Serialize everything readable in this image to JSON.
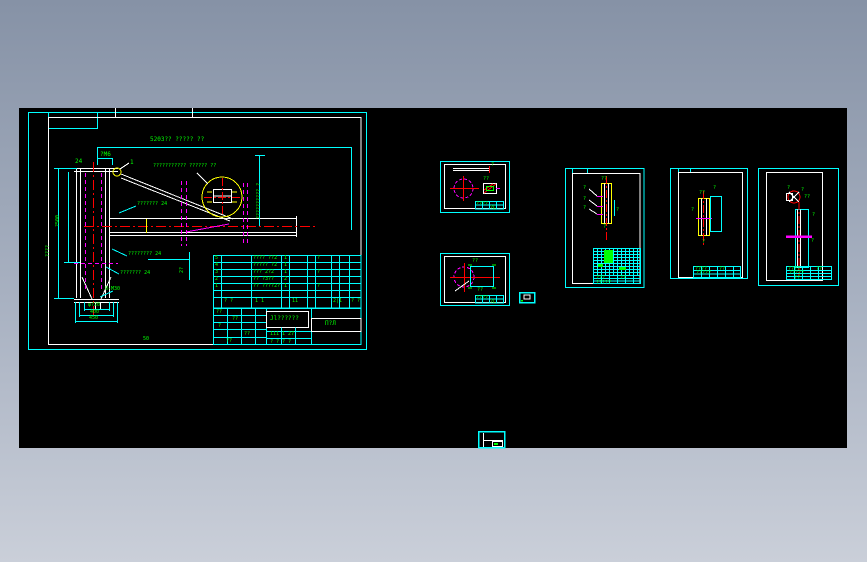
{
  "app": {
    "type": "cad-drawing-viewer",
    "canvas_color": "#000000",
    "background_top": "#8692a6",
    "background_bottom": "#cacfd9"
  },
  "palette": {
    "sheet_frame": "#00ffff",
    "inner_frame": "#ffffff",
    "annotation": "#00ff00",
    "centerline": "#ff0000",
    "hidden_line": "#ff00ff",
    "detail": "#ffff00"
  },
  "main_sheet": {
    "labels": {
      "dim_top": "5203?? ????? ??",
      "leader_detail": "??????????? ?????? ??",
      "detail_no": "1",
      "note_m6": "?M6",
      "note_24": "24",
      "leader_mid": "??????? 24",
      "leader_low": "???????? 24",
      "leader_lower": "??????? 24",
      "anchor": "8-M30",
      "base_d1": "φ?20",
      "base_d2": "400",
      "base_d3": "450",
      "dim_left_outer": "????",
      "dim_left_inner": "?500",
      "dim_right_vert": "?????????? ?",
      "dim_gap": "2?",
      "sheet_no": "50"
    },
    "bom": {
      "rows": [
        {
          "no": "5",
          "name": "???? ??2",
          "qty": "1",
          "mat": "?"
        },
        {
          "no": "4",
          "name": "????? ?2",
          "qty": "1",
          "mat": ""
        },
        {
          "no": "3",
          "name": "??? 2?2",
          "qty": "1",
          "mat": "?"
        },
        {
          "no": "2",
          "name": "?? ?3??",
          "qty": "2",
          "mat": ""
        },
        {
          "no": "1",
          "name": "?? ????2?",
          "qty": "1",
          "mat": "?"
        }
      ],
      "footer": [
        "? ?",
        "1 1",
        "11",
        "2|1",
        "? ?"
      ]
    },
    "title_block": {
      "title": "Jl??????",
      "code": "П?Л",
      "sub": "111 1 27",
      "bottom": "? ? ? ?",
      "cells": [
        "??",
        "??",
        "?",
        "??",
        "??"
      ]
    }
  },
  "sheet_a": {
    "labels": {
      "tick": "?",
      "note": "??",
      "t1": "????",
      "t2": "?L"
    }
  },
  "sheet_b": {
    "labels": {
      "note_top": "??",
      "note_bottom": "??",
      "t1": "????",
      "t2": "?L"
    }
  },
  "sheet_c": {
    "labels": {
      "top": "??",
      "bottom": "?",
      "side": "?",
      "m1": "?",
      "m2": "?",
      "m3": "?",
      "t1": "???",
      "t2": "??",
      "t3": "?????"
    }
  },
  "sheet_d": {
    "labels": {
      "top": "??",
      "bottom": "?",
      "right": "?",
      "left": "?",
      "t1": "????",
      "t2": "??",
      "t3": "?????"
    }
  },
  "sheet_e": {
    "labels": {
      "w1": "?",
      "w2": "??",
      "w3": "?",
      "m1": "?",
      "m2": "?",
      "m3": "??",
      "t1": "????",
      "t2": "??",
      "t3": "?????"
    }
  }
}
